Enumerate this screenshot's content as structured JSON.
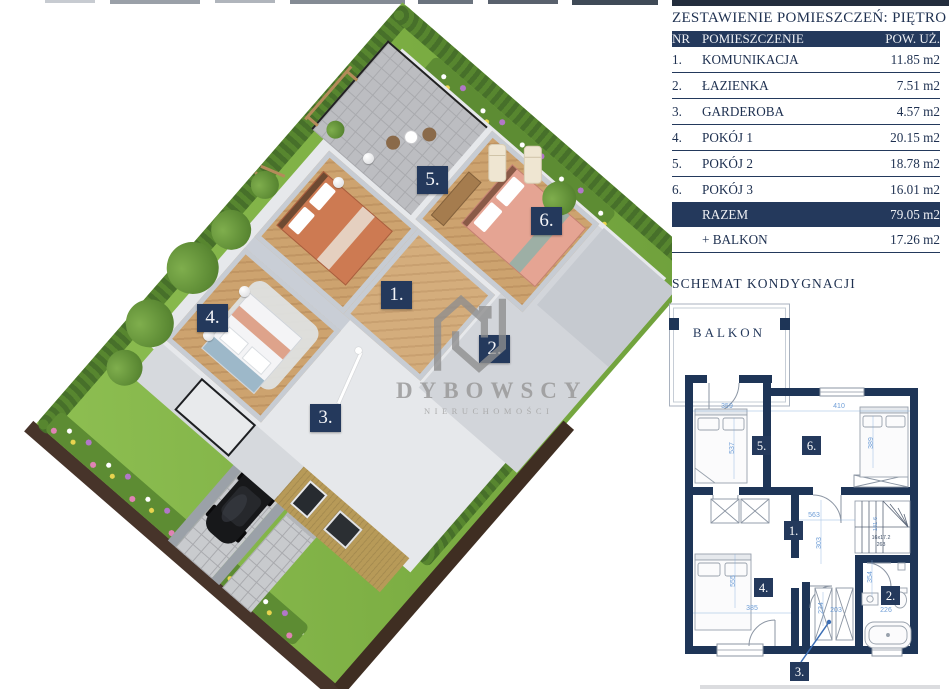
{
  "brand": {
    "name": "DYBOWSCY",
    "subtitle": "NIERUCHOMOŚCI"
  },
  "table": {
    "title": "ZESTAWIENIE POMIESZCZEŃ: PIĘTRO",
    "columns": {
      "nr": "NR",
      "name": "POMIESZCZENIE",
      "area": "POW. UŻ."
    },
    "rows": [
      {
        "nr": "1.",
        "name": "KOMUNIKACJA",
        "area": "11.85 m2"
      },
      {
        "nr": "2.",
        "name": "ŁAZIENKA",
        "area": "7.51 m2"
      },
      {
        "nr": "3.",
        "name": "GARDEROBA",
        "area": "4.57 m2"
      },
      {
        "nr": "4.",
        "name": "POKÓJ 1",
        "area": "20.15 m2"
      },
      {
        "nr": "5.",
        "name": "POKÓJ 2",
        "area": "18.78 m2"
      },
      {
        "nr": "6.",
        "name": "POKÓJ 3",
        "area": "16.01 m2"
      }
    ],
    "total": {
      "name": "RAZEM",
      "area": "79.05 m2"
    },
    "extra": {
      "name": "+ BALKON",
      "area": "17.26 m2"
    }
  },
  "plan": {
    "title": "SCHEMAT KONDYGNACJI",
    "balcony": "BALKON",
    "stairs": {
      "note1": "16x17.2",
      "note2": "263",
      "dim": "181-6"
    },
    "dims": {
      "room5_w": "359",
      "room5_h": "537",
      "room6_w": "410",
      "room6_h": "389",
      "hall_w": "563",
      "hall_h": "303",
      "room4_w": "385",
      "room4_h": "555",
      "bath_w": "226",
      "bath_h": "354",
      "ward_w": "203",
      "ward_h": "234"
    }
  },
  "markers": {
    "m1": "1.",
    "m2": "2.",
    "m3": "3.",
    "m4": "4.",
    "m5": "5.",
    "m6": "6."
  }
}
